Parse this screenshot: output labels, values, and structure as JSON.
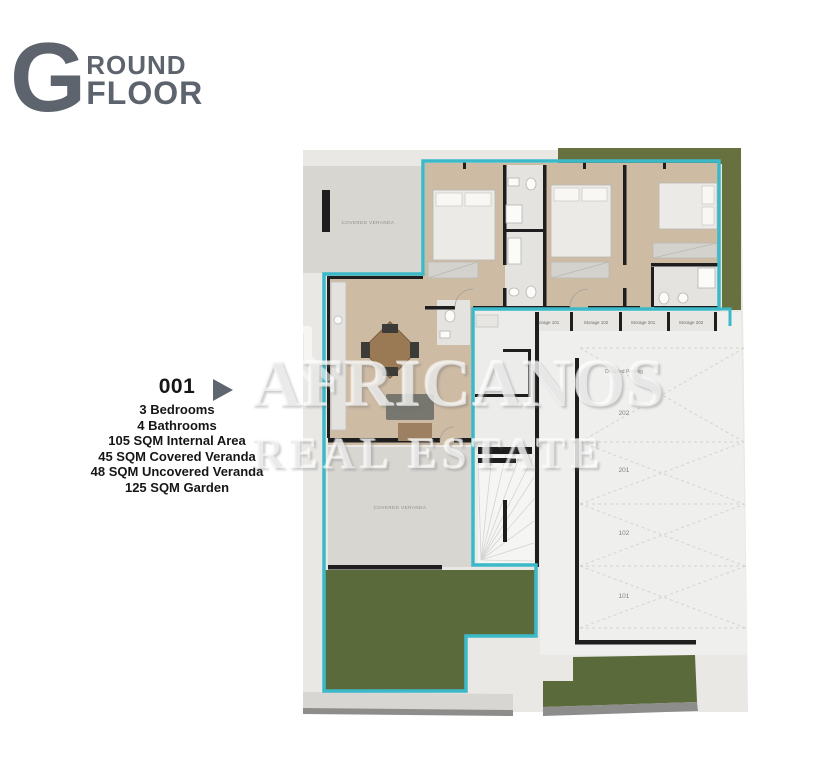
{
  "header": {
    "logo_letter": "G",
    "logo_word_top": "ROUND",
    "logo_word_bottom": "FLOOR",
    "logo_color": "#5d646d"
  },
  "unit_marker": {
    "number": "001",
    "details": [
      "3 Bedrooms",
      "4 Bathrooms",
      "105 SQM Internal Area",
      "45 SQM Covered Veranda",
      "48 SQM Uncovered Veranda",
      "125 SQM Garden"
    ]
  },
  "watermark": {
    "brand_line1": "AFRICANOS",
    "brand_line2": "REAL ESTATE",
    "logo_icon": "house-outline-icon"
  },
  "floor_plan": {
    "labels": {
      "covered_veranda_top": "COVERED VERANDA",
      "covered_veranda_bottom": "COVERED VERANDA",
      "disabled_parking": "Disabled Parking",
      "storages": [
        "Storage 101",
        "Storage 102",
        "Storage 201",
        "Storage 202"
      ],
      "parking_spots": [
        "202",
        "201",
        "102",
        "101"
      ]
    },
    "colors": {
      "boundary": "#3cb9c9",
      "garden": "#5b6a3b",
      "hedge": "#66713f",
      "floor_tan": "#cdbba4",
      "veranda": "#d8d6d1",
      "site": "#e9e8e5",
      "parking": "#efefed",
      "bath": "#e4e3e0",
      "wall": "#1e1e1e"
    }
  }
}
